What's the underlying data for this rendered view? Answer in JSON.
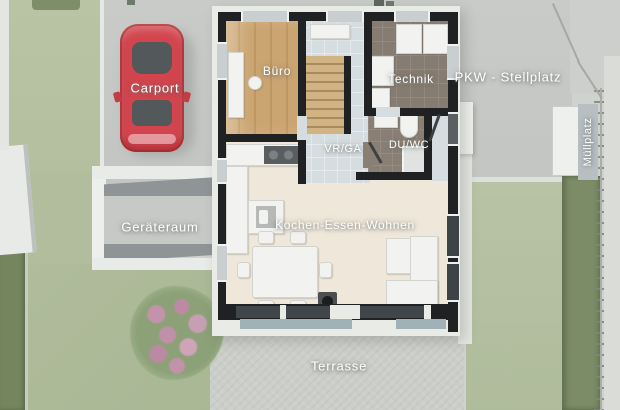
{
  "plan": {
    "labels": {
      "carport": "Carport",
      "pkw_stellplatz": "PKW - Stellplatz",
      "muellplatz": "Müllplatz",
      "buero": "Büro",
      "technik": "Technik",
      "vr_ga": "VR/GA",
      "du_wc": "DU/WC",
      "kochen_essen_wohnen": "Kochen-Essen-Wohnen",
      "geraeteraum": "Geräteraum",
      "terrasse": "Terrasse"
    },
    "colors": {
      "car_red": "#d2454e",
      "grass_green": "#b5c1a1",
      "hedge_green": "#7b8c66",
      "paving_gray": "#c6c8c6",
      "terrace_gray": "#cccec9",
      "wall_black": "#1f2123",
      "wood_floor": "#c9a46f",
      "living_floor": "#efe7d9",
      "hall_tile": "#d6dde0",
      "dark_tile": "#867c72",
      "label_text": "#ffffff"
    }
  }
}
